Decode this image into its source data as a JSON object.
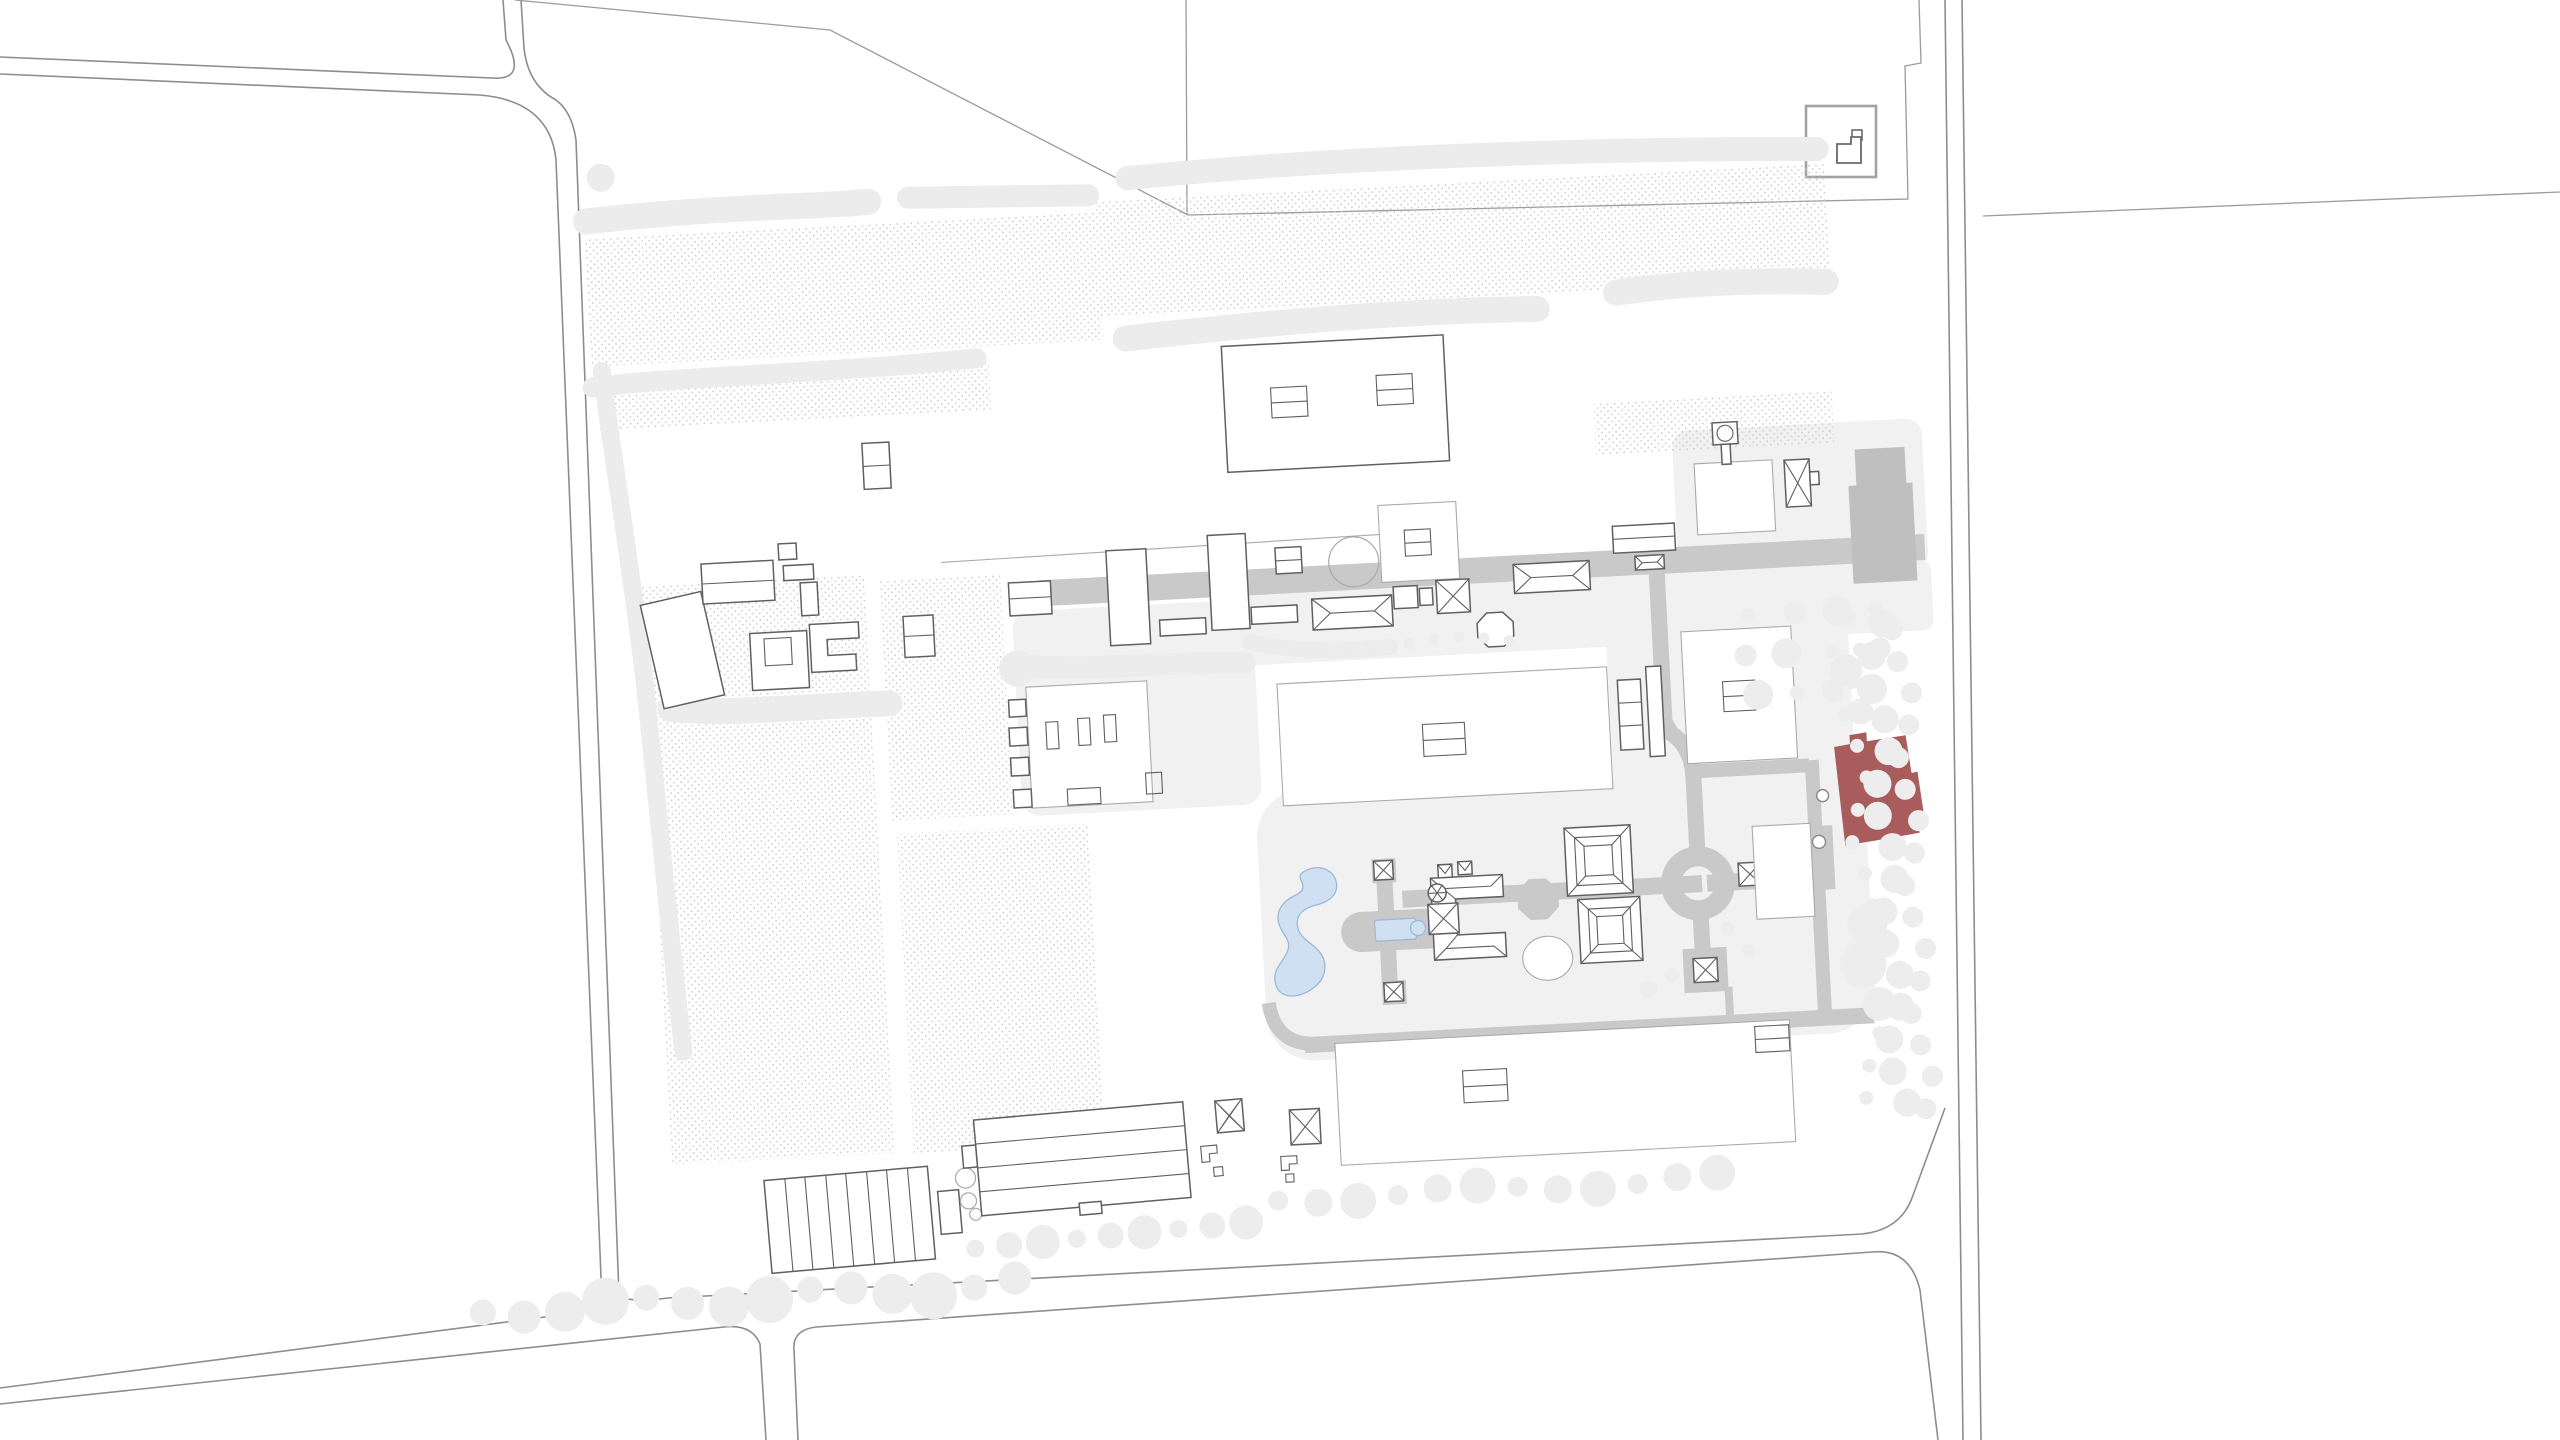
{
  "document": {
    "kind": "architectural-site-plan",
    "visible_text": "",
    "highlighted_buildings_count": 1
  },
  "map": {
    "colors": {
      "background": "#ffffff",
      "road_stroke": "#8d8d8d",
      "parcel_stroke": "#9b9b9b",
      "building_stroke": "#606060",
      "building_fill": "#ffffff",
      "lot_stroke": "#aaaaaa",
      "garden_path": "#c9c9c9",
      "garden_path_dark": "#bfbfbf",
      "platform": "#f1f1f1",
      "vegetation": "#ececec",
      "tree": "#ededed",
      "field_dots": "#cbcbcb",
      "water_fill": "#cfe0f3",
      "water_stroke": "#9db8d8",
      "highlight": "#a85c5c"
    },
    "features": {
      "highlighted_building": "red-highlighted-building",
      "inset": "key-plan-locator",
      "water_bodies": [
        "serpentine-pond",
        "rectangular-basin"
      ],
      "garden_elements": [
        "octagon-plaza",
        "circular-fountain",
        "terraced-parterre-upper",
        "terraced-parterre-lower",
        "palace-complex"
      ],
      "field_texture": "orchard-dot-hatch"
    }
  }
}
